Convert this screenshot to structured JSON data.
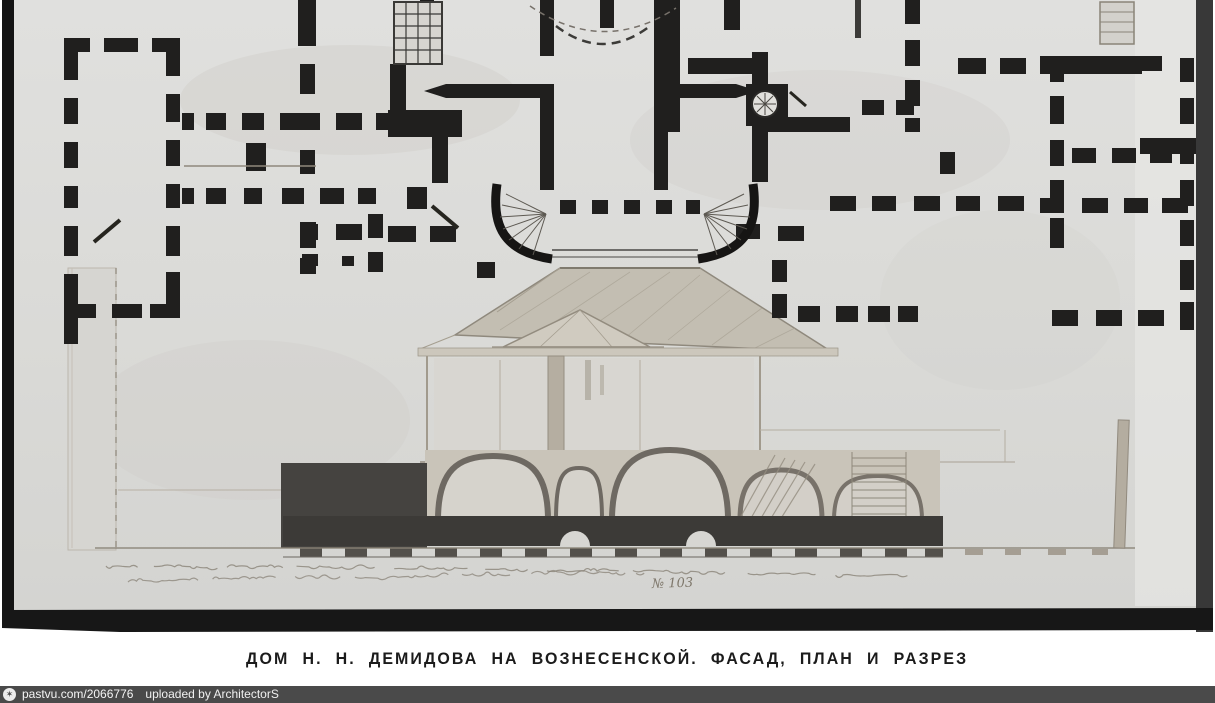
{
  "caption": {
    "text": "ДОМ Н. Н. ДЕМИДОВА НА ВОЗНЕСЕНСКОЙ. ФАСАД, ПЛАН И РАЗРЕЗ"
  },
  "watermark": {
    "site": "pastvu.com/2066776",
    "uploaded_by": "uploaded by ArchitectorS",
    "icon": "star-in-circle",
    "bar_color": "#4a4a4a"
  },
  "inscription": {
    "number": "№ 103"
  },
  "colors": {
    "paper": "#dcdcda",
    "plan_ink": "#201f1e",
    "wash": "#b5aea2",
    "dark_mass": "#3f3d3a",
    "frame": "#171717"
  }
}
